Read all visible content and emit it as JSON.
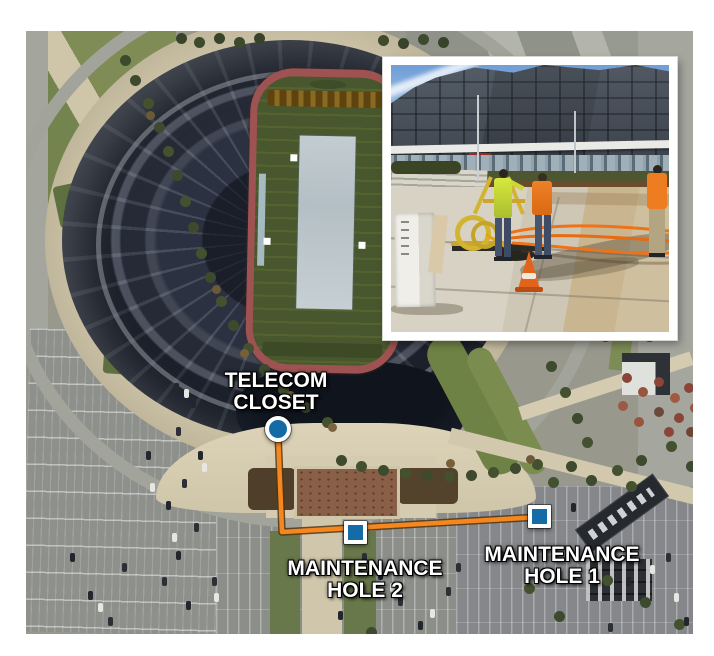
{
  "figure": {
    "type": "annotated-aerial-map",
    "annotations": {
      "telecom_closet": {
        "line1": "TELECOM",
        "line2": "CLOSET",
        "marker_shape": "circle"
      },
      "maintenance_hole_2": {
        "line1": "MAINTENANCE",
        "line2": "HOLE 2",
        "marker_shape": "square"
      },
      "maintenance_hole_1": {
        "line1": "MAINTENANCE",
        "line2": "HOLE 1",
        "marker_shape": "square"
      }
    },
    "colors": {
      "route_orange": "#f6871f",
      "route_outline": "#503510",
      "marker_blue": "#156ba5",
      "marker_border": "#ffffff",
      "label_text": "#ffffff",
      "label_outline": "#000000",
      "inset_frame": "#ffffff"
    },
    "inset": {
      "description": "ground-level photo of utility crew pulling orange cable from a maintenance hole in front of the stadium"
    }
  }
}
